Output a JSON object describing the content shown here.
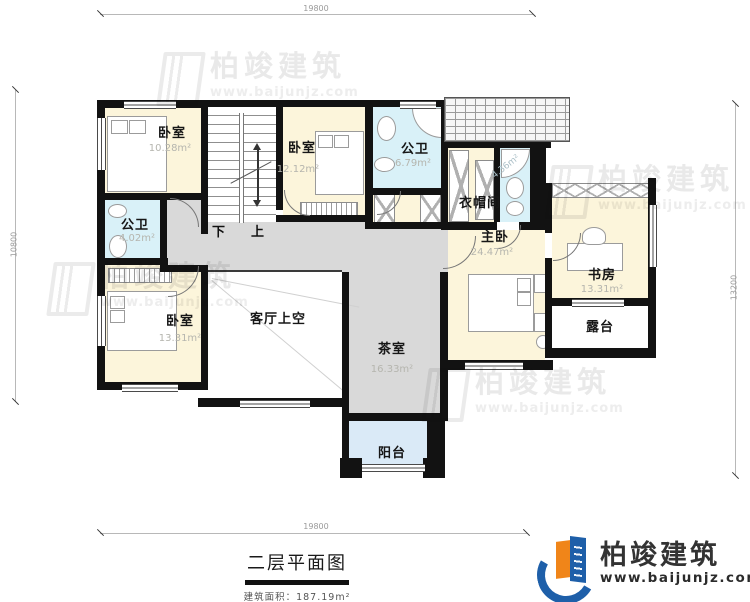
{
  "plan": {
    "stairs": {
      "down": "下",
      "up": "上"
    }
  },
  "rooms": {
    "bedroom_top_left": {
      "label": "卧室",
      "area": "10.28m²"
    },
    "bedroom_top_middle": {
      "label": "卧室",
      "area": "12.12m²"
    },
    "bath_top": {
      "label": "公卫",
      "area": "6.79m²"
    },
    "cloakroom": {
      "label": "衣帽间"
    },
    "ensuite_bath": {
      "area": "4.36m²"
    },
    "master_bedroom": {
      "label": "主卧",
      "area": "24.47m²"
    },
    "study": {
      "label": "书房",
      "area": "13.31m²"
    },
    "terrace": {
      "label": "露台"
    },
    "bath_left": {
      "label": "公卫",
      "area": "4.02m²"
    },
    "bedroom_bottom_left": {
      "label": "卧室",
      "area": "13.31m²"
    },
    "living_room_void": {
      "label": "客厅上空"
    },
    "tea_room": {
      "label": "茶室",
      "area": "16.33m²"
    },
    "balcony": {
      "label": "阳台"
    }
  },
  "dimensions": {
    "top": "19800",
    "bottom": "19800",
    "left": "10800",
    "right": "13200"
  },
  "title_block": {
    "title": "二层平面图",
    "area_label": "建筑面积：",
    "area_value": "187.19m²"
  },
  "logo": {
    "name": "柏竣建筑",
    "url": "www.baijunjz.com"
  },
  "watermark": {
    "name": "柏竣建筑",
    "url": "www.baijunjz.com"
  },
  "colors": {
    "wall": "#121212",
    "bedroom_fill": "#fcf5db",
    "bath_fill": "#d9f1f8",
    "hall_fill": "#d9d9d9",
    "balcony_fill": "#daeaf7",
    "logo_blue": "#1e5fa9",
    "logo_orange": "#f08519"
  }
}
